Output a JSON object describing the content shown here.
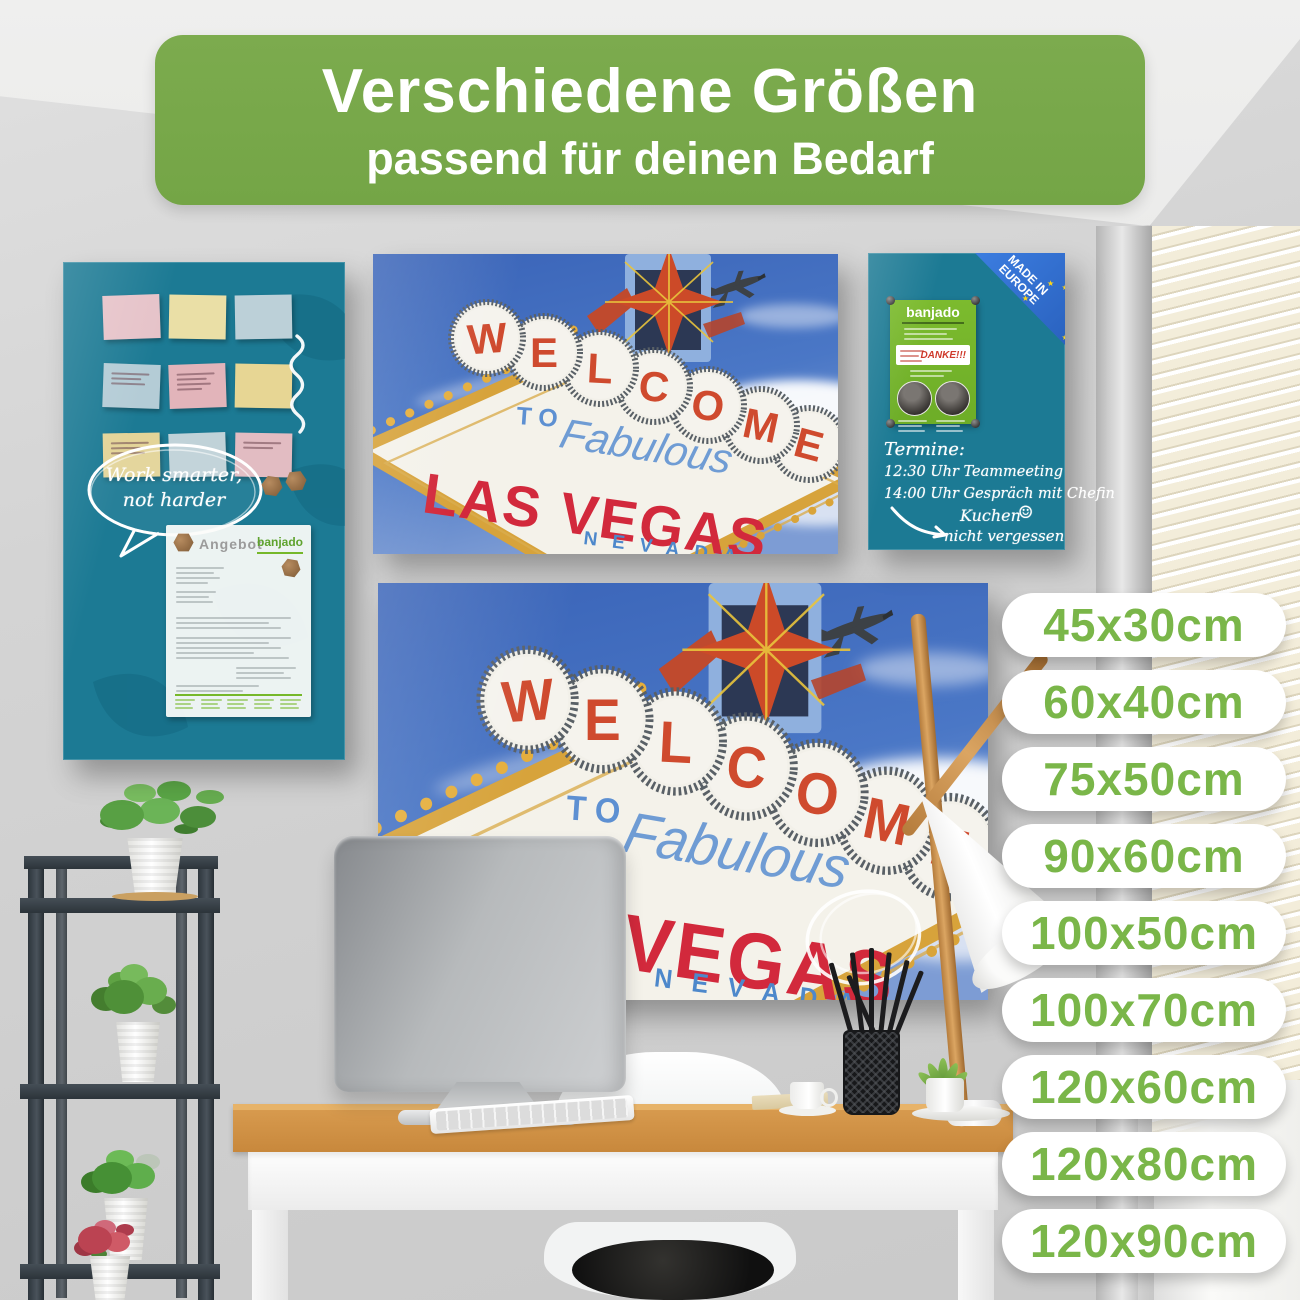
{
  "banner": {
    "title": "Verschiedene Größen",
    "subtitle": "passend für deinen Bedarf"
  },
  "sizes": {
    "items": [
      "45x30cm",
      "60x40cm",
      "75x50cm",
      "90x60cm",
      "100x50cm",
      "100x70cm",
      "120x60cm",
      "120x80cm",
      "120x90cm"
    ]
  },
  "vegas": {
    "letters": [
      "W",
      "E",
      "L",
      "C",
      "O",
      "M",
      "E"
    ],
    "to": "TO",
    "fabulous": "Fabulous",
    "city": "LAS VEGAS",
    "state": "NEVADA"
  },
  "notes_board": {
    "speech_bubble_line1": "Work smarter,",
    "speech_bubble_line2": "not harder",
    "document_title": "Angebot",
    "document_logo": "banjado",
    "sticky_notes": [
      {
        "color": "#e6c3c9",
        "lines": 0
      },
      {
        "color": "#eadfa6",
        "lines": 0
      },
      {
        "color": "#bcd0d8",
        "lines": 0
      },
      {
        "color": "#b4ccd6",
        "lines": 3
      },
      {
        "color": "#e2b4ba",
        "lines": 4
      },
      {
        "color": "#e7d694",
        "lines": 0
      },
      {
        "color": "#e3d498",
        "lines": 3
      },
      {
        "color": "#c0d2d8",
        "lines": 0
      },
      {
        "color": "#e2bcc2",
        "lines": 2
      }
    ]
  },
  "appointments_board": {
    "ribbon_line1": "MADE IN",
    "ribbon_line2": "EUROPE",
    "flyer_logo": "banjado",
    "flyer_thanks": "DANKE!!!",
    "chalk_heading": "Termine:",
    "chalk_line1": "12:30 Uhr Teammeeting",
    "chalk_line2": "14:00 Uhr Gespräch mit Chefin",
    "chalk_note_line1": "Kuchen",
    "chalk_note_line2": "nicht vergessen",
    "smiley": "☺"
  },
  "colors": {
    "banner_green": "#76a848",
    "pill_text_green": "#7ab649",
    "board_teal": "#1c7a94",
    "banjado_green": "#76b82a",
    "vegas_red": "#d2293c",
    "vegas_blue": "#4d88cb",
    "ribbon_blue": "#2f6fd2"
  }
}
